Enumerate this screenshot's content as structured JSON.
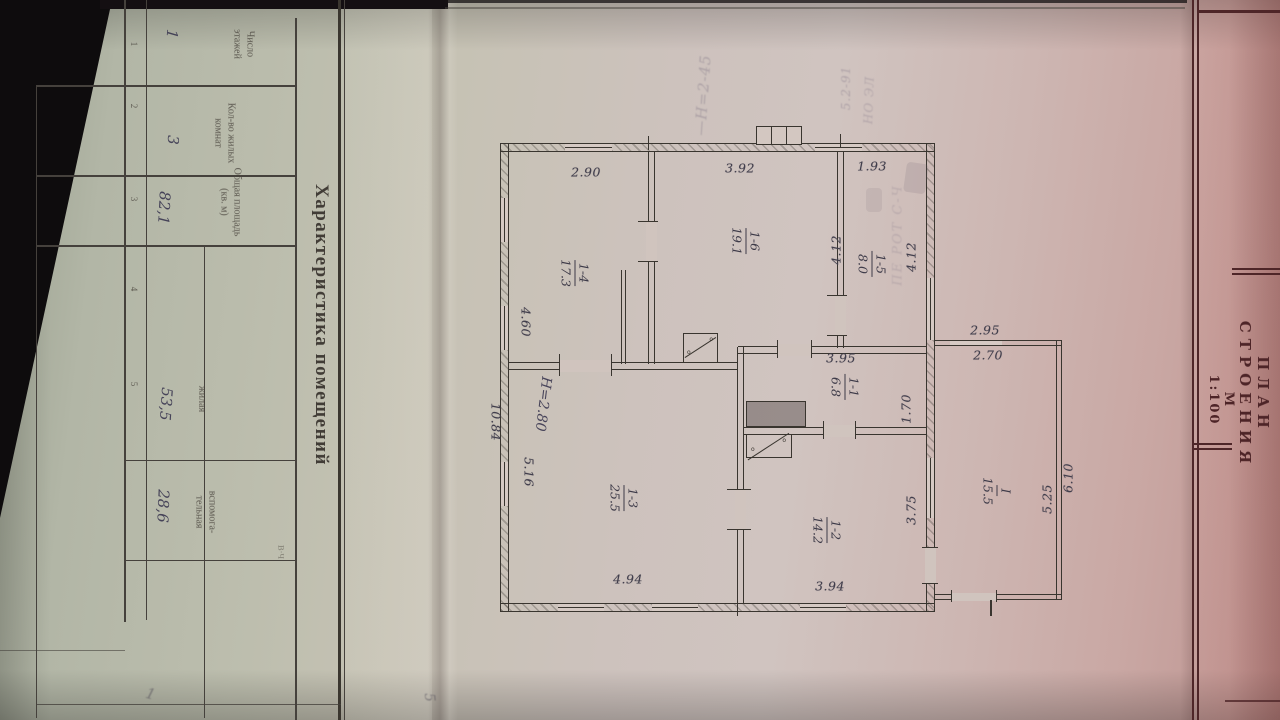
{
  "title_block": {
    "title": "ПЛАН СТРОЕНИЯ",
    "scale": "М 1:100"
  },
  "table": {
    "title": "Характеристика помещений",
    "columns": [
      {
        "no": "1",
        "header": "Число\nэтажей",
        "value": "1"
      },
      {
        "no": "2",
        "header": "Кол-во жилых\nкомнат",
        "value": "3"
      },
      {
        "no": "3",
        "header": "Общая площадь\n(кв. м)",
        "value": "82,1"
      },
      {
        "no": "4",
        "header": "жилая",
        "value": "53,5"
      },
      {
        "no": "5",
        "header": "вспомога-\nтельная",
        "value": "28,6"
      }
    ],
    "note": "В·Ч"
  },
  "plan": {
    "height_note": "Н=2.80",
    "rooms": [
      {
        "number": "1-4",
        "area": "17.3"
      },
      {
        "number": "1-6",
        "area": "19.1"
      },
      {
        "number": "1-5",
        "area": "8.0"
      },
      {
        "number": "1-1",
        "area": "6.8"
      },
      {
        "number": "1-3",
        "area": "25.5"
      },
      {
        "number": "1-2",
        "area": "14.2"
      },
      {
        "number": "I",
        "area": "15.5"
      }
    ],
    "dims": {
      "top": [
        "2.90",
        "3.92",
        "1.93"
      ],
      "bottom": [
        "4.94",
        "3.94"
      ],
      "left": [
        "4.60",
        "10.84",
        "5.16"
      ],
      "right": [
        "4.12",
        "4.12",
        "1.70",
        "3.75"
      ],
      "annex_top": [
        "2.95",
        "2.70"
      ],
      "annex_right": [
        "6.10",
        "5.25"
      ],
      "inner": [
        "3.95"
      ]
    }
  },
  "ghost_marks": {
    "a": "—Н=2-45",
    "b": "5.2-91",
    "c": "НО ЭЛ",
    "d": "ПЕ РОТ С-Ч",
    "e": "1",
    "f": "5"
  }
}
